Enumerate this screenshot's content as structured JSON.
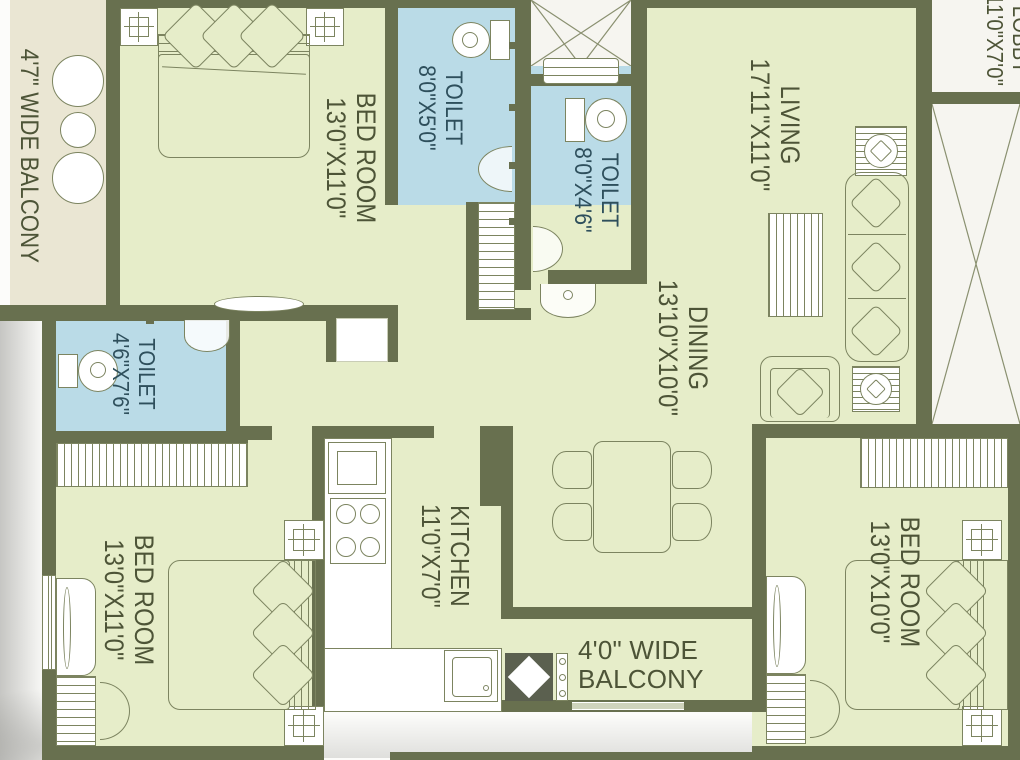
{
  "title": "2BHK/3BHK apartment floor plan",
  "colors": {
    "wall": "#68704f",
    "room_green": "#e6edc9",
    "toilet_blue": "#badbe7",
    "balcony_beige": "#eae6d3",
    "furniture_outline": "#7c8460",
    "label_text": "#4d5437",
    "toilet_label_text": "#2e4f5c",
    "void_white": "#f6f5f0",
    "balcony_entry_gray": "#5b604f"
  },
  "rooms": {
    "balcony_left": {
      "label": "4'7\" WIDE BALCONY"
    },
    "bedroom_top_left": {
      "name": "BED ROOM",
      "dims": "13'0\"X11'0\""
    },
    "toilet_top": {
      "name": "TOILET",
      "dims": "8'0\"X5'0\""
    },
    "toilet_mid": {
      "name": "TOILET",
      "dims": "8'0\"X4'6\""
    },
    "living": {
      "name": "LIVING",
      "dims": "17'11\"X11'0\""
    },
    "dining": {
      "name": "DINING",
      "dims": "13'10\"X10'0\""
    },
    "toilet_left": {
      "name": "TOILET",
      "dims": "4'6\"X7'6\""
    },
    "bedroom_bottom_left": {
      "name": "BED ROOM",
      "dims": "13'0\"X11'0\""
    },
    "kitchen": {
      "name": "KITCHEN",
      "dims": "11'0\"X7'0\""
    },
    "balcony_bottom": {
      "line1": "4'0\" WIDE",
      "line2": "BALCONY"
    },
    "bedroom_bottom_right": {
      "name": "BED ROOM",
      "dims": "13'0\"X10'0\""
    },
    "lobby": {
      "name": "LOBBY",
      "dims": "11'0\"X7'0\""
    }
  },
  "icons": {
    "ceiling_fan": "square-crosshair",
    "fan_unit": "striped-square-circle",
    "wc": "tank-plus-oval-bowl-top-view",
    "washbasin": "half-oval-on-wall",
    "shower": "half-disc-on-wall",
    "bed": "mattress-headboard-pillows",
    "sofa": "three-seater-outline",
    "armchair": "single-seater-outline",
    "side_table": "striped-square-circle",
    "rug": "striped-rectangle",
    "dining_table": "rect-table-4-chairs",
    "stove": "four-burner-hob",
    "kitchen_sink": "square-basin",
    "wardrobe": "hatched-strip",
    "round_table": "circles",
    "washing_area": "diamond-in-dark-square",
    "duct_shaft": "x-cross-void",
    "staircase_void": "diagonal-cross",
    "stairs": "hatched-steps",
    "door_swing": "quarter-arc",
    "shelf": "ellipse-on-wall"
  }
}
